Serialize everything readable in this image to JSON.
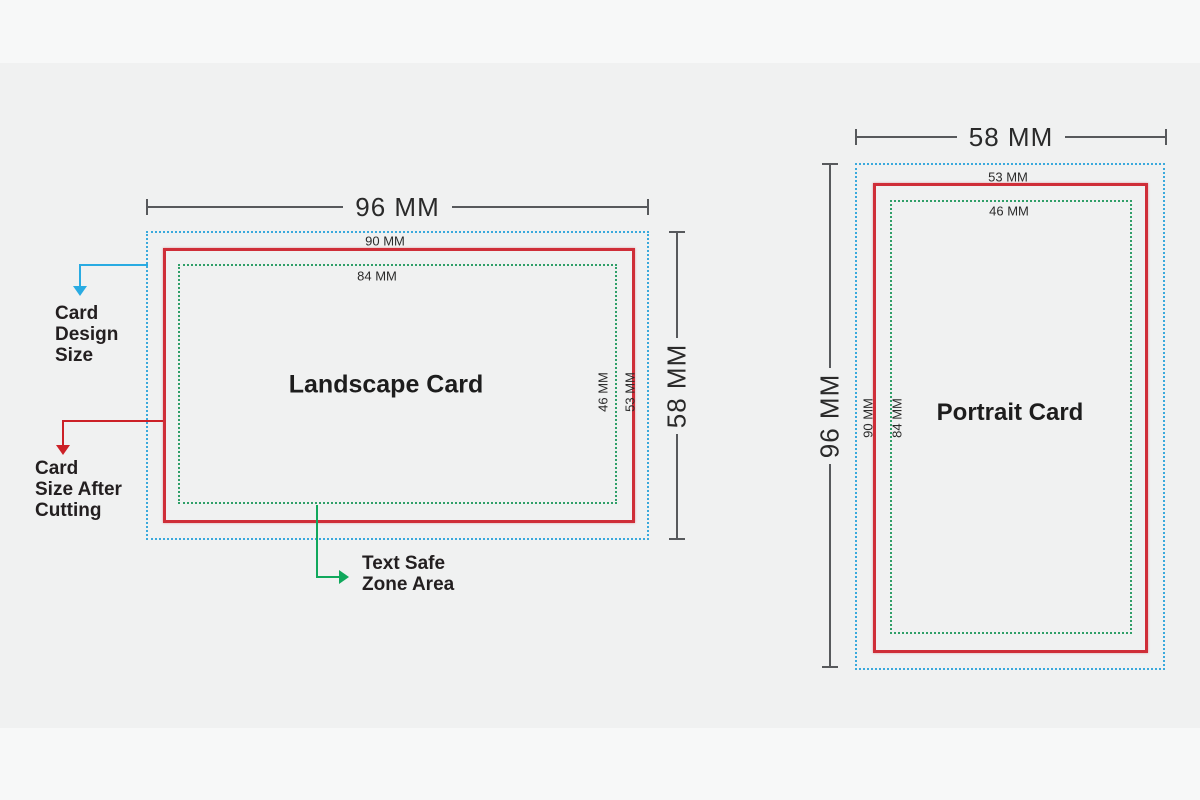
{
  "background": {
    "top_strip_color": "#f7f8f8",
    "content_band_color": "#f0f1f1"
  },
  "colors": {
    "design_border": "#3aa9dc",
    "cut_border": "#cf2e38",
    "safe_border": "#2f9f68",
    "dimension_line": "#57595c",
    "design_arrow": "#29abe2",
    "cut_arrow": "#cc2127",
    "safe_arrow": "#10a85c",
    "text": "#231f20"
  },
  "landscape": {
    "title": "Landscape Card",
    "design_width": "96 MM",
    "design_height": "58 MM",
    "cut_width": "90 MM",
    "cut_height": "53 MM",
    "safe_width": "84 MM",
    "safe_height": "46 MM"
  },
  "portrait": {
    "title": "Portrait Card",
    "design_width": "58 MM",
    "design_height": "96 MM",
    "cut_width": "53 MM",
    "cut_height": "90 MM",
    "safe_width": "46 MM",
    "safe_height": "84 MM"
  },
  "annotations": {
    "design_size": "Card\nDesign\nSize",
    "cut_size": "Card\nSize After\nCutting",
    "safe_zone": "Text Safe\nZone Area"
  }
}
